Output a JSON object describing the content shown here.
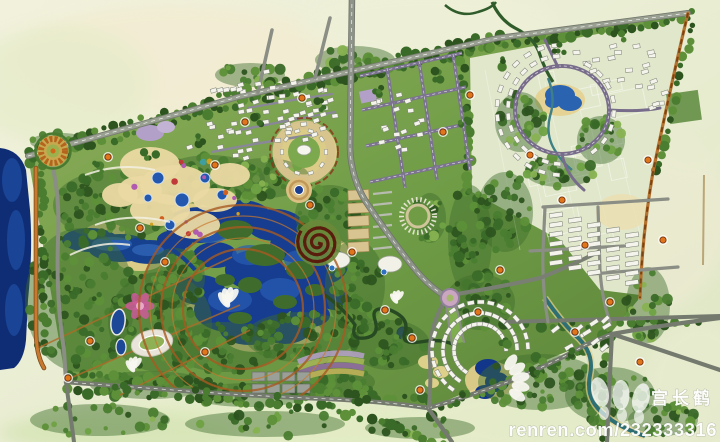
{
  "document": {
    "kind": "landscape-masterplan-aerial-rendering",
    "description": "Painted master plan of a resort park: central lake with islands, theme-park zones, circular plazas, residential loop, street grid and boundary roads"
  },
  "watermark": {
    "site_text": "renren.com/232333316",
    "artist_text": "宫长鹤"
  },
  "palette": {
    "wash_pale": "#eff0dc",
    "wash_green": "#dde7c2",
    "site_green": "#6f9c46",
    "forest_dark": "#2d541f",
    "forest_light": "#87b251",
    "lake_deep": "#163d8f",
    "lake_dark": "#0f2d74",
    "lake_light": "#4f86c8",
    "beach_tan": "#e6d08f",
    "road_gray": "#747a6e",
    "road_purple": "#7b7390",
    "road_orange": "#c8792e",
    "node_orange": "#e0761c",
    "accent_spiral": "#5a1c0c",
    "accent_pink": "#cc5a9a",
    "building_white": "#f4f3ec"
  },
  "features": [
    "north-boundary-road",
    "right-boundary-road",
    "left-lakeside-road",
    "south-boundary-road",
    "central-arterial-road",
    "street-grid",
    "residential-loop",
    "central-lake",
    "west-lake-strip",
    "theme-park-zone",
    "spiral-pavilion",
    "circular-plaza",
    "fountain-plaza",
    "west-roundabout",
    "stadium-oval",
    "flower-garden",
    "fan-resort-village",
    "lagoon",
    "terraced-gardens",
    "parking-lots",
    "future-phase-fields",
    "tree-canopy",
    "orange-node-markers"
  ]
}
